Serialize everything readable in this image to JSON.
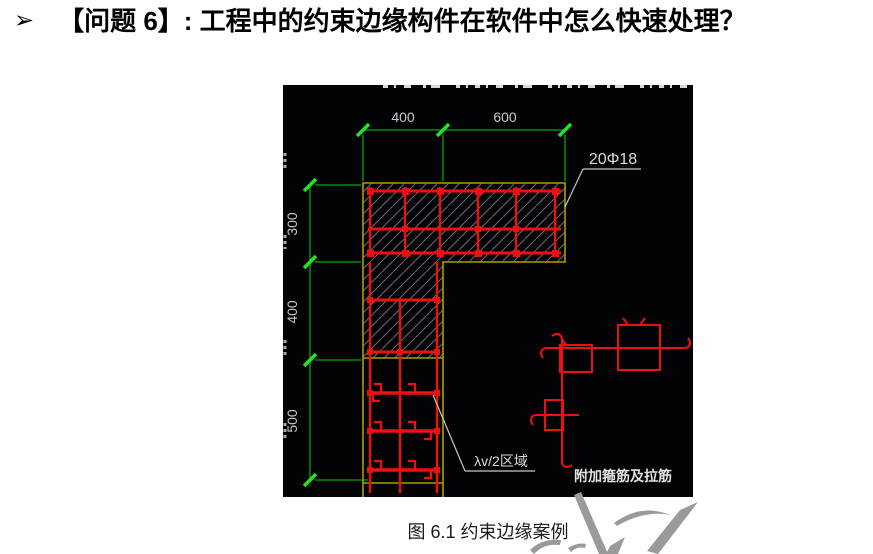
{
  "title": {
    "bullet": "➢",
    "text": "【问题 6】: 工程中的约束边缘构件在软件中怎么快速处理？"
  },
  "figure": {
    "caption": "图 6.1 约束边缘案例",
    "drawing": {
      "top_dims": [
        "400",
        "600"
      ],
      "left_dims": [
        "300",
        "400",
        "500"
      ],
      "rebar_label": "20Φ18",
      "zone_label": "λv/2区域",
      "detail_label": "附加箍筋及拉筋",
      "colors": {
        "background": "#030306",
        "dimension_line": "#00A800",
        "tick": "#22E422",
        "outline": "#A8A000",
        "rebar": "#EE1010",
        "hatch": "#6A6A7A",
        "annotation_text": "#D6D6D6",
        "watermark": "#9A9A9A"
      }
    }
  }
}
